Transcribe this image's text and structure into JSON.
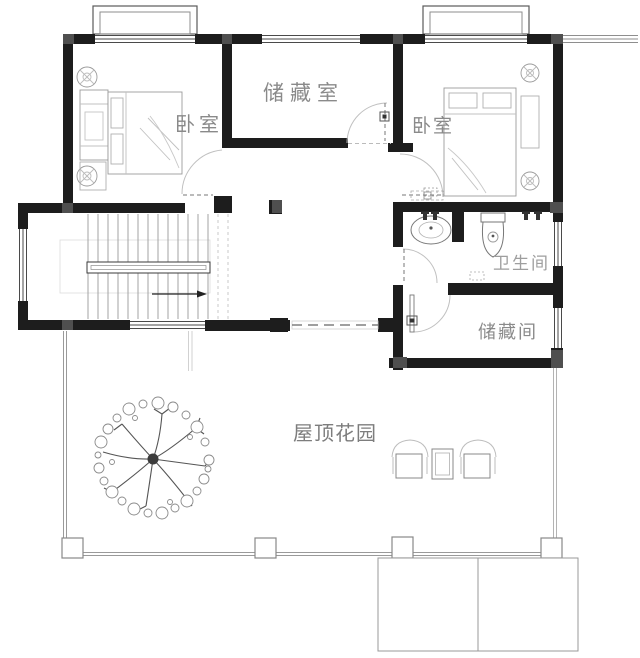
{
  "rooms": {
    "bedroom_left": "卧室",
    "storage_room": "储藏室",
    "bedroom_right": "卧室",
    "bathroom": "卫生间",
    "storage_small": "储藏间",
    "roof_garden": "屋顶花园"
  },
  "colors": {
    "wall": "#1d1d1d",
    "corner_block": "#4f4f4f",
    "thin_line": "#8e8e8e",
    "furniture_line": "#9b9b9b",
    "label": "#8a8a8a",
    "background": "#ffffff"
  },
  "features": [
    "staircase-icon",
    "direction-arrow-icon",
    "tree-icon",
    "armchair-icon",
    "side-table-icon",
    "washbasin-icon",
    "toilet-icon",
    "double-bed-icon",
    "wardrobe-icon",
    "potted-plant-icon",
    "door-swing-icon",
    "sliding-door-icon",
    "bay-window-icon",
    "roof-slab-icon"
  ]
}
